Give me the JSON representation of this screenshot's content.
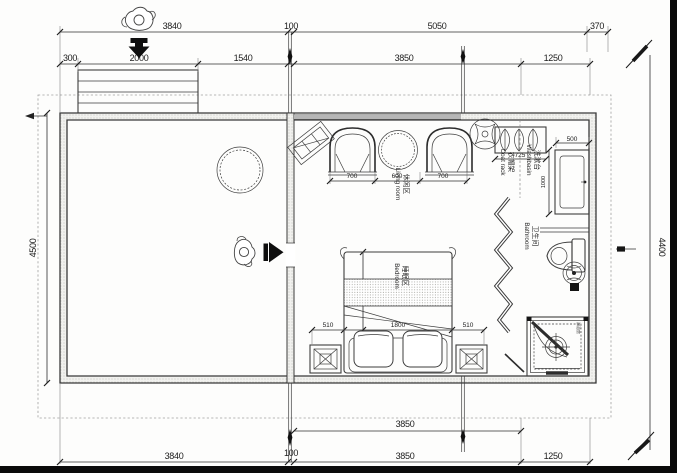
{
  "colors": {
    "line": "#3d3d3d",
    "dim_text": "#1b1b1b",
    "wall_fill": "#efefec",
    "frame": "#0a0a0a",
    "canopy_dash": "#9f9f9f"
  },
  "dimensions": {
    "top_row1": [
      "3840",
      "100",
      "5050",
      "370"
    ],
    "top_row2": [
      "300",
      "2000",
      "1540",
      "3850",
      "1250"
    ],
    "bottom_row1": [
      "3850"
    ],
    "bottom_row2": [
      "3840",
      "100",
      "3850",
      "1250"
    ],
    "left_side": "4500",
    "right_side": "4400",
    "living_widths": [
      "700",
      "600",
      "700"
    ],
    "coat_rack_width": "725",
    "washbasin_width": "500",
    "washbasin_depth": "1000",
    "bed_side_left": "510",
    "bed_width": "1800",
    "bed_side_right": "510",
    "bed_length": "2000"
  },
  "labels": {
    "living_zh": "休闲区",
    "living_en": "Living room",
    "bedroom_zh": "睡眠区",
    "bedroom_en": "Bedroom",
    "coat_rack_zh": "衣帽架",
    "coat_rack_en": "Coat rack",
    "washbasin_zh": "洗漱台",
    "washbasin_en": "Washbasin",
    "bathroom_zh": "卫生间",
    "bathroom_en": "Bathroom",
    "shower_zh": "淋浴房"
  }
}
